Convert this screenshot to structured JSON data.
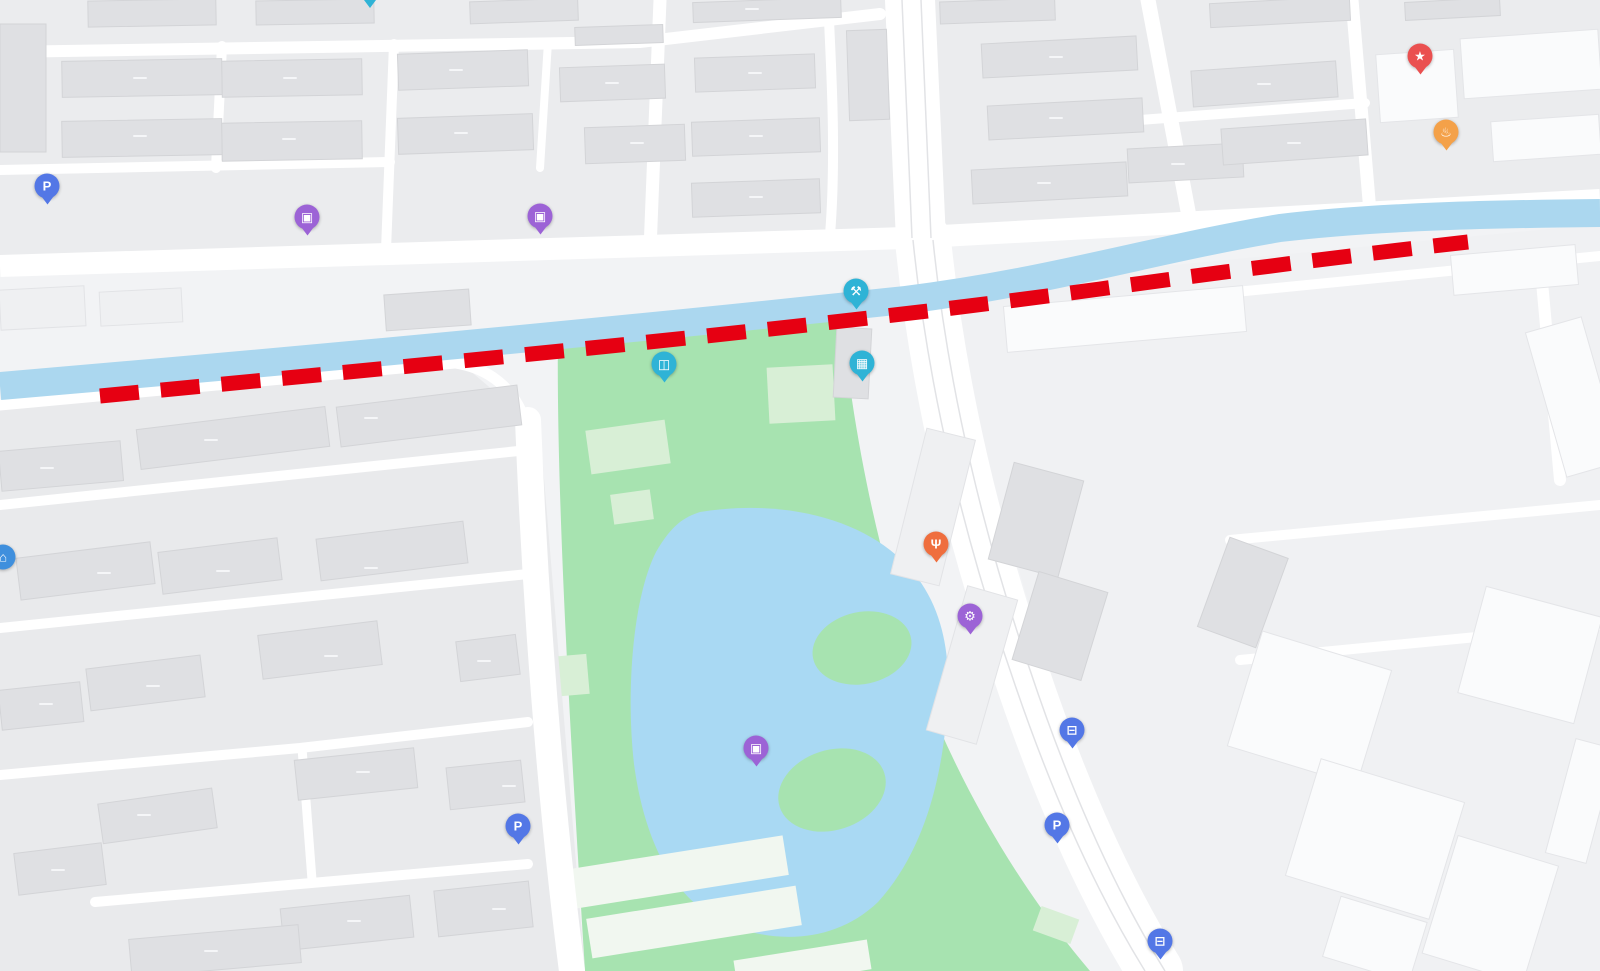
{
  "map": {
    "park_name": "竹西公园",
    "residential_area_name": "御龙湾花园",
    "river_name": "冷却河",
    "roads": [
      "上方寺路",
      "江都北路"
    ]
  },
  "colors": {
    "teal": "#2fb3d6",
    "purple": "#9c63d6",
    "red": "#ea5050",
    "orange": "#f4a149",
    "red_orange": "#ef6e3e",
    "blue": "#5377e6",
    "sky_blue": "#3f8fdd",
    "dash_red": "#e60012",
    "river": "#abd7ef",
    "park": "#a7e3b0",
    "lake": "#a9d9f3"
  },
  "icon_glyphs": {
    "pin_tip": "",
    "shop": "▣",
    "wrench": "⚒",
    "ad_building": "▦",
    "gate": "◫",
    "star": "★",
    "bowl": "♨",
    "fork": "Ψ",
    "gear": "⚙",
    "parking": "P",
    "bus": "⊟",
    "home": "⌂"
  },
  "labels": [
    {
      "text": "34号楼",
      "x": 140,
      "y": 78,
      "cls": "bldg"
    },
    {
      "text": "27号楼",
      "x": 290,
      "y": 78,
      "cls": "bldg"
    },
    {
      "text": "20号楼",
      "x": 456,
      "y": 70,
      "cls": "bldg"
    },
    {
      "text": "13号楼",
      "x": 612,
      "y": 83,
      "cls": "bldg"
    },
    {
      "text": "3号楼",
      "x": 755,
      "y": 73,
      "cls": "bldg"
    },
    {
      "text": "4号楼",
      "x": 752,
      "y": 9,
      "cls": "bldg"
    },
    {
      "text": "33号楼",
      "x": 140,
      "y": 136,
      "cls": "bldg"
    },
    {
      "text": "26号楼",
      "x": 289,
      "y": 139,
      "cls": "bldg"
    },
    {
      "text": "19号楼",
      "x": 461,
      "y": 133,
      "cls": "bldg"
    },
    {
      "text": "12号楼",
      "x": 637,
      "y": 143,
      "cls": "bldg"
    },
    {
      "text": "2号楼",
      "x": 756,
      "y": 136,
      "cls": "bldg"
    },
    {
      "text": "1号楼",
      "x": 756,
      "y": 197,
      "cls": "bldg"
    },
    {
      "text": "40号楼",
      "x": 1056,
      "y": 57,
      "cls": "bldg"
    },
    {
      "text": "39号楼",
      "x": 1056,
      "y": 118,
      "cls": "bldg"
    },
    {
      "text": "38号楼",
      "x": 1044,
      "y": 183,
      "cls": "bldg"
    },
    {
      "text": "33号楼",
      "x": 1178,
      "y": 164,
      "cls": "bldg"
    },
    {
      "text": "25号楼",
      "x": 1264,
      "y": 84,
      "cls": "bldg"
    },
    {
      "text": "24号楼",
      "x": 1294,
      "y": 143,
      "cls": "bldg"
    },
    {
      "text": "22幢",
      "x": 47,
      "y": 468,
      "cls": "bldg"
    },
    {
      "text": "17幢",
      "x": 211,
      "y": 440,
      "cls": "bldg"
    },
    {
      "text": "6幢",
      "x": 371,
      "y": 418,
      "cls": "bldg"
    },
    {
      "text": "21幢",
      "x": 104,
      "y": 573,
      "cls": "bldg"
    },
    {
      "text": "11幢",
      "x": 223,
      "y": 571,
      "cls": "bldg"
    },
    {
      "text": "5幢",
      "x": 371,
      "y": 568,
      "cls": "bldg"
    },
    {
      "text": "10幢",
      "x": 331,
      "y": 656,
      "cls": "bldg"
    },
    {
      "text": "4幢",
      "x": 484,
      "y": 661,
      "cls": "bldg"
    },
    {
      "text": "15幢",
      "x": 153,
      "y": 686,
      "cls": "bldg"
    },
    {
      "text": "20幢",
      "x": 46,
      "y": 704,
      "cls": "bldg"
    },
    {
      "text": "9幢",
      "x": 363,
      "y": 772,
      "cls": "bldg"
    },
    {
      "text": "3幢",
      "x": 509,
      "y": 786,
      "cls": "bldg"
    },
    {
      "text": "13A幢",
      "x": 144,
      "y": 815,
      "cls": "bldg"
    },
    {
      "text": "19幢",
      "x": 58,
      "y": 870,
      "cls": "bldg"
    },
    {
      "text": "8幢",
      "x": 354,
      "y": 921,
      "cls": "bldg"
    },
    {
      "text": "2幢",
      "x": 499,
      "y": 909,
      "cls": "bldg"
    },
    {
      "text": "13号楼",
      "x": 211,
      "y": 951,
      "cls": "bldg"
    },
    {
      "text": "御龙湾花园",
      "x": 256,
      "y": 746,
      "cls": "area"
    },
    {
      "text": "竹西公园",
      "x": 801,
      "y": 823,
      "cls": "park"
    },
    {
      "text": "上方寺路",
      "x": 83,
      "y": 265,
      "cls": "road",
      "rot": -3
    },
    {
      "text": "上方寺路",
      "x": 403,
      "y": 265,
      "cls": "road",
      "rot": -3
    },
    {
      "text": "上方寺路",
      "x": 1136,
      "y": 233,
      "cls": "road",
      "rot": -4
    },
    {
      "text": "上方寺路",
      "x": 1354,
      "y": 206,
      "cls": "road",
      "rot": -4
    },
    {
      "text": "江都北路",
      "x": 917,
      "y": 136,
      "cls": "roadv",
      "rot": 8
    },
    {
      "text": "江都北路",
      "x": 982,
      "y": 452,
      "cls": "roadv",
      "rot": 12
    },
    {
      "text": "江都北路",
      "x": 1030,
      "y": 655,
      "cls": "roadv",
      "rot": 14
    },
    {
      "text": "冷却河",
      "x": 411,
      "y": 356,
      "cls": "river",
      "rot": -6
    },
    {
      "text": "冷却河",
      "x": 1317,
      "y": 247,
      "cls": "river",
      "rot": -6
    },
    {
      "text": "天禹跆拳道馆",
      "x": 371,
      "y": 27,
      "cls": "poi"
    },
    {
      "text": "锦飞水暖电器",
      "x": 237,
      "y": 211,
      "cls": "poi"
    },
    {
      "text": "五金工具日杂",
      "x": 240,
      "y": 234,
      "cls": "poi"
    },
    {
      "text": "欧意电器",
      "x": 535,
      "y": 244,
      "cls": "poi"
    },
    {
      "text": "家电维修",
      "x": 912,
      "y": 281,
      "cls": "poi"
    },
    {
      "text": "调剂回收",
      "x": 913,
      "y": 305,
      "cls": "poi"
    },
    {
      "text": "金蚂蚁广告",
      "x": 926,
      "y": 366,
      "cls": "poi"
    },
    {
      "text": "北门",
      "x": 663,
      "y": 394,
      "cls": "poi"
    },
    {
      "text": "扬州安徽商会",
      "x": 1421,
      "y": 86,
      "cls": "poi"
    },
    {
      "text": "小蒋子食府",
      "x": 1510,
      "y": 134,
      "cls": "poi"
    },
    {
      "text": "明皓私房菜",
      "x": 938,
      "y": 572,
      "cls": "poi"
    },
    {
      "text": "翠云足疗",
      "x": 970,
      "y": 646,
      "cls": "poi"
    },
    {
      "text": "ANNLAI安黎小镇",
      "x": 757,
      "y": 779,
      "cls": "poi"
    },
    {
      "text": "湾二期",
      "x": 24,
      "y": 589,
      "cls": "poi"
    },
    {
      "text": "村",
      "x": 5,
      "y": 48,
      "cls": "partial"
    },
    {
      "text": "↑",
      "x": 909,
      "y": 60,
      "cls": "arrow"
    },
    {
      "text": "↑",
      "x": 955,
      "y": 349,
      "cls": "arrow",
      "rot": -12
    },
    {
      "text": "↑",
      "x": 1116,
      "y": 812,
      "cls": "arrow",
      "rot": 12
    }
  ],
  "pins": [
    {
      "icon": "pin_tip",
      "color": "teal",
      "x": 370,
      "y": 4,
      "cls": "tip-only",
      "name": "taekwondo-gym-pin"
    },
    {
      "icon": "shop",
      "color": "purple",
      "x": 307,
      "y": 217,
      "name": "hardware-store-pin"
    },
    {
      "icon": "shop",
      "color": "purple",
      "x": 540,
      "y": 216,
      "name": "appliance-store-pin"
    },
    {
      "icon": "wrench",
      "color": "teal",
      "x": 856,
      "y": 291,
      "name": "appliance-repair-pin"
    },
    {
      "icon": "ad_building",
      "color": "teal",
      "x": 862,
      "y": 363,
      "name": "ad-company-pin"
    },
    {
      "icon": "gate",
      "color": "teal",
      "x": 664,
      "y": 364,
      "name": "north-gate-pin"
    },
    {
      "icon": "star",
      "color": "red",
      "x": 1420,
      "y": 56,
      "name": "chamber-of-commerce-pin"
    },
    {
      "icon": "bowl",
      "color": "orange",
      "x": 1446,
      "y": 132,
      "name": "restaurant-pin"
    },
    {
      "icon": "fork",
      "color": "red_orange",
      "x": 936,
      "y": 544,
      "name": "restaurant-pin"
    },
    {
      "icon": "gear",
      "color": "purple",
      "x": 970,
      "y": 616,
      "name": "foot-massage-pin"
    },
    {
      "icon": "shop",
      "color": "purple",
      "x": 756,
      "y": 748,
      "name": "shop-pin"
    },
    {
      "icon": "parking",
      "color": "blue",
      "x": 47,
      "y": 186,
      "name": "parking-pin"
    },
    {
      "icon": "parking",
      "color": "blue",
      "x": 518,
      "y": 826,
      "name": "parking-pin"
    },
    {
      "icon": "parking",
      "color": "blue",
      "x": 1057,
      "y": 825,
      "name": "parking-pin"
    },
    {
      "icon": "bus",
      "color": "blue",
      "x": 1072,
      "y": 730,
      "name": "bus-stop-pin"
    },
    {
      "icon": "bus",
      "color": "blue",
      "x": 1160,
      "y": 941,
      "name": "bus-stop-pin"
    },
    {
      "icon": "home",
      "color": "sky_blue",
      "x": 3,
      "y": 557,
      "cls": "no-tail",
      "name": "residence-pin"
    }
  ]
}
